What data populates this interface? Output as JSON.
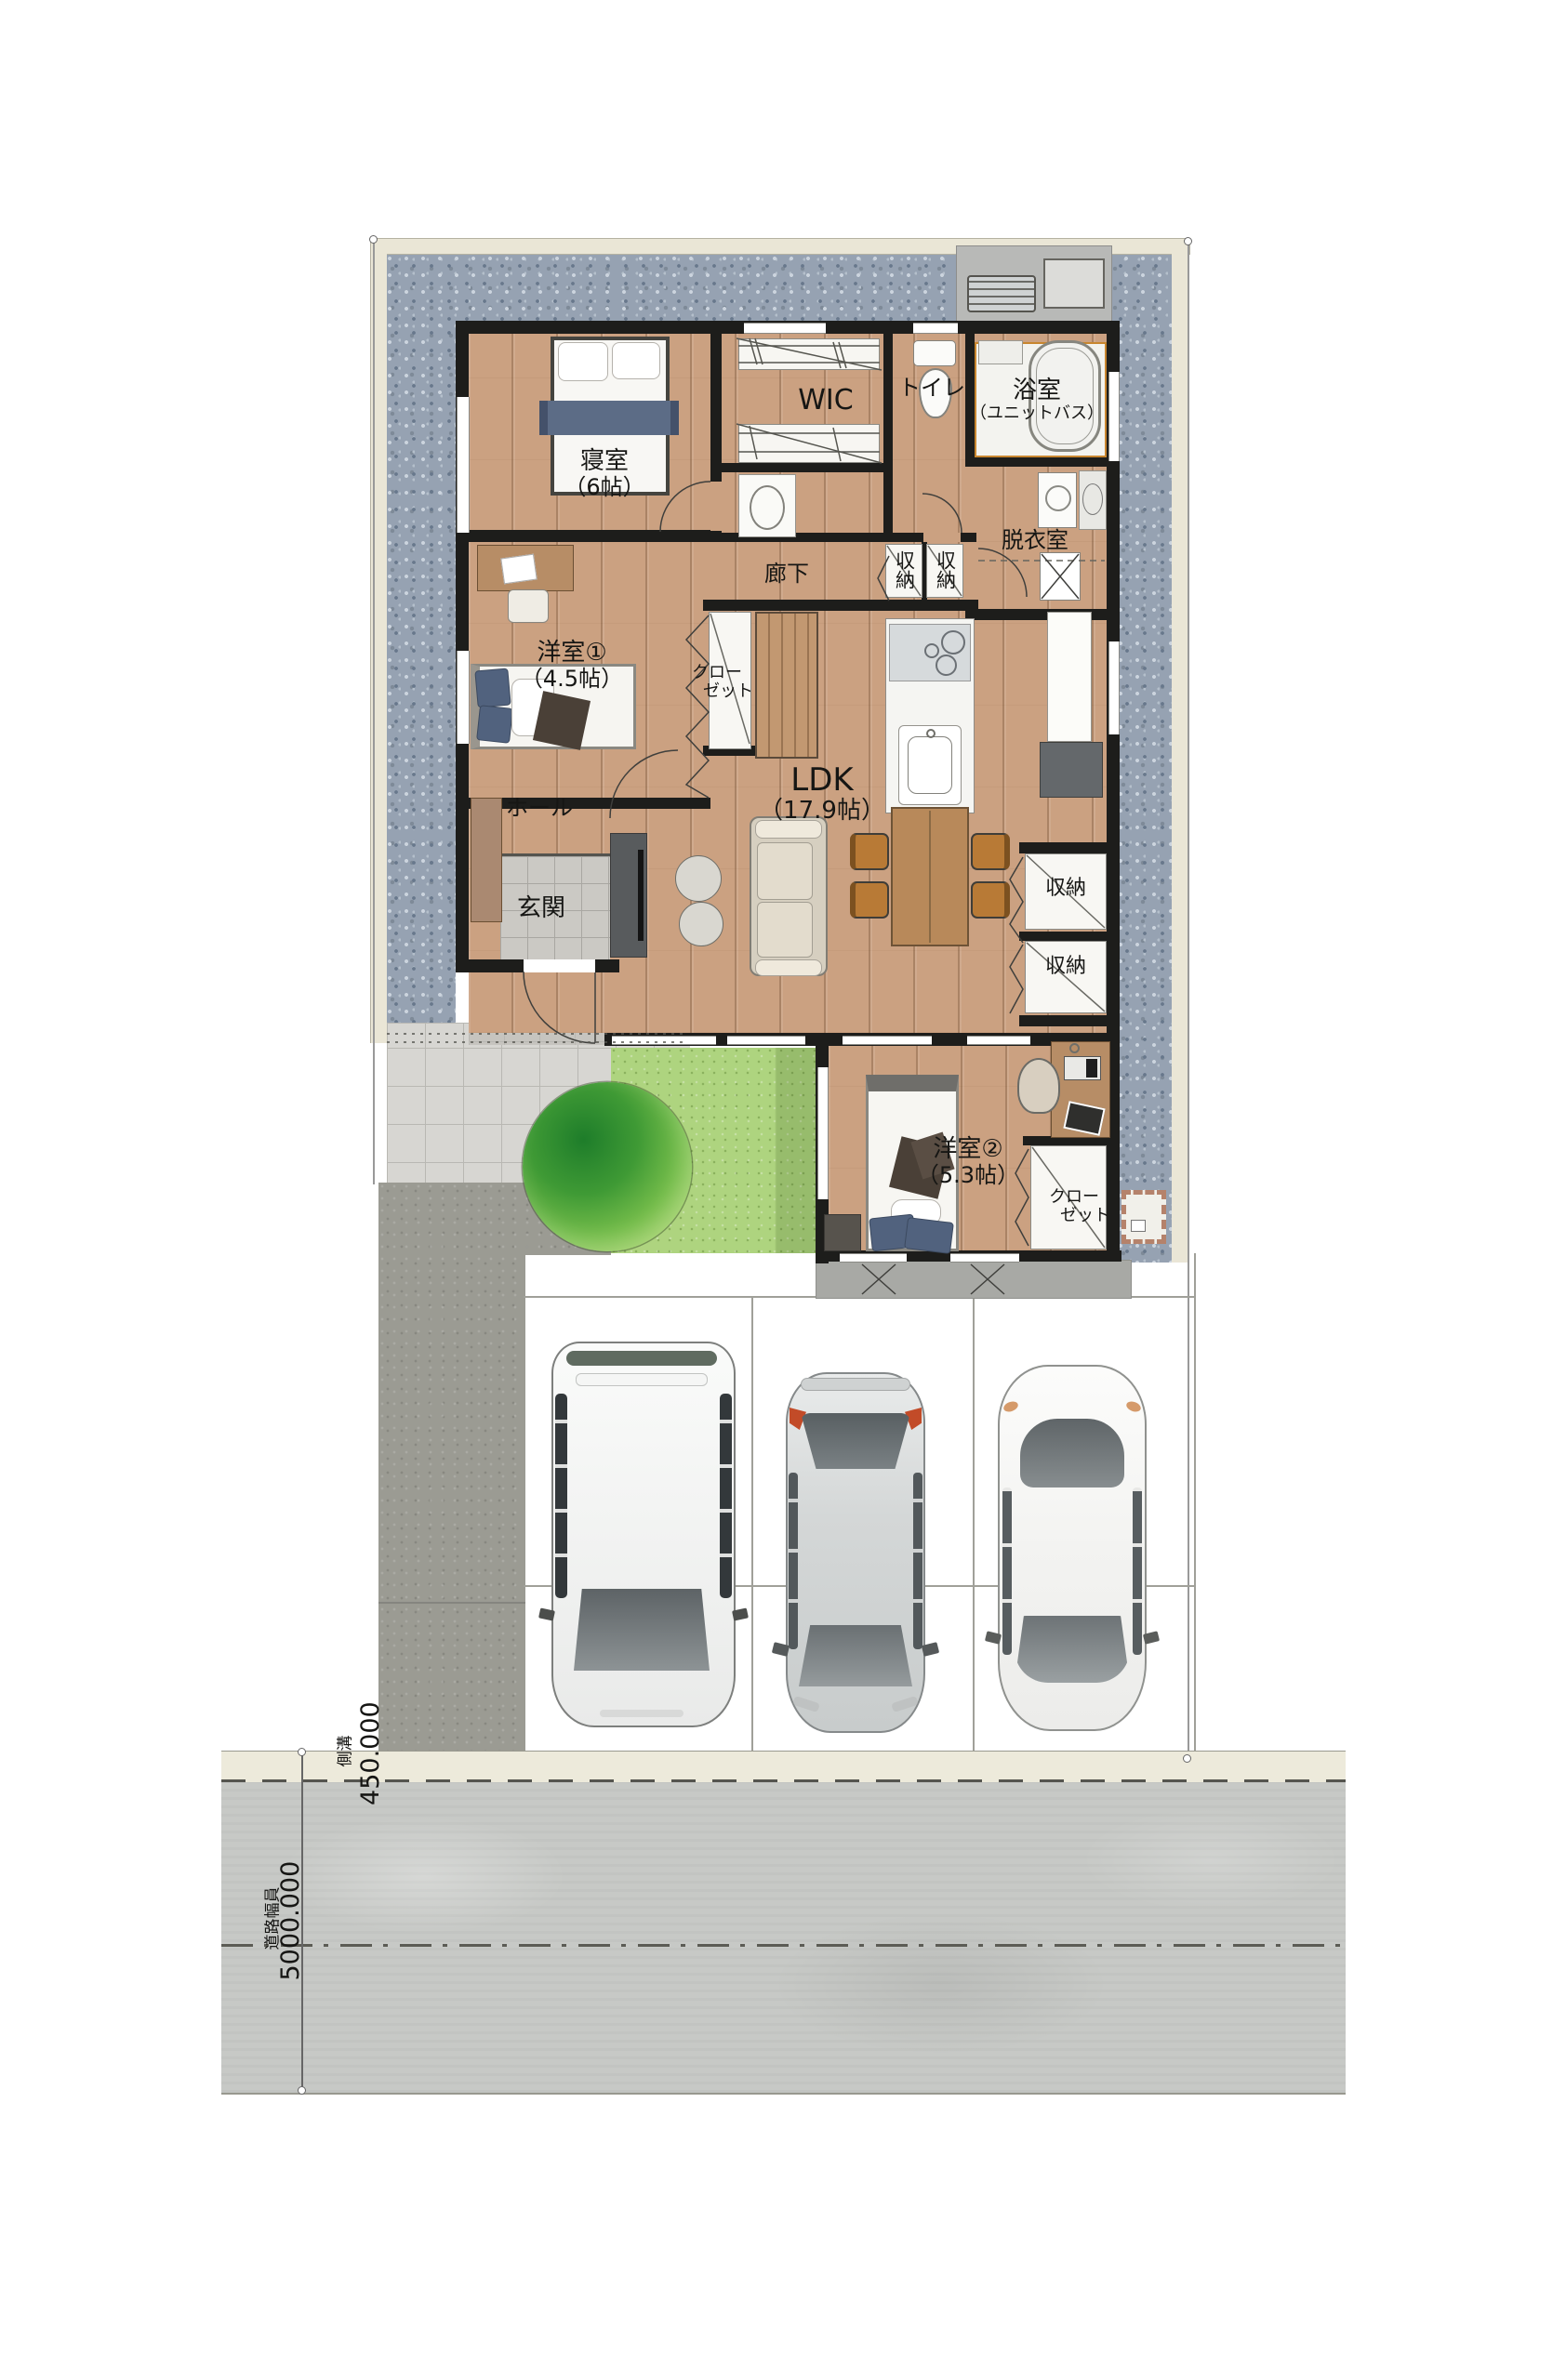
{
  "document": {
    "type": "floor-plan-site-drawing"
  },
  "rooms": {
    "bedroom": {
      "name": "寝室",
      "size": "（6帖）"
    },
    "wic": {
      "name": "WIC"
    },
    "toilet": {
      "name": "トイレ"
    },
    "bathroom": {
      "name": "浴室",
      "type": "（ユニットバス）"
    },
    "dressing_room": {
      "name": "脱衣室"
    },
    "corridor": {
      "name": "廊下"
    },
    "western_room_1": {
      "name": "洋室①",
      "size": "（4.5帖）"
    },
    "western_room_2": {
      "name": "洋室②",
      "size": "（5.3帖）"
    },
    "hall": {
      "name": "ホール"
    },
    "entrance": {
      "name": "玄関"
    },
    "ldk": {
      "name": "LDK",
      "size": "（17.9帖）"
    },
    "storage": {
      "name": "収納"
    },
    "closet": {
      "line1": "クロー",
      "line2": "ゼット"
    }
  },
  "site": {
    "gutter_label": "側溝",
    "gutter_dim": "450.000",
    "road_label": "道路幅員",
    "road_dim": "5000.000"
  },
  "colors": {
    "wall": "#1d1d1b",
    "wood_floor": "#cba181",
    "gravel": "#96a2b2",
    "lawn": "#aed47f",
    "road": "#c7c9c6",
    "gutter": "#edeadb",
    "unit_bath_frame": "#c8862f",
    "dining_chair": "#b87a36",
    "bed_blanket": "#5c6c86"
  }
}
